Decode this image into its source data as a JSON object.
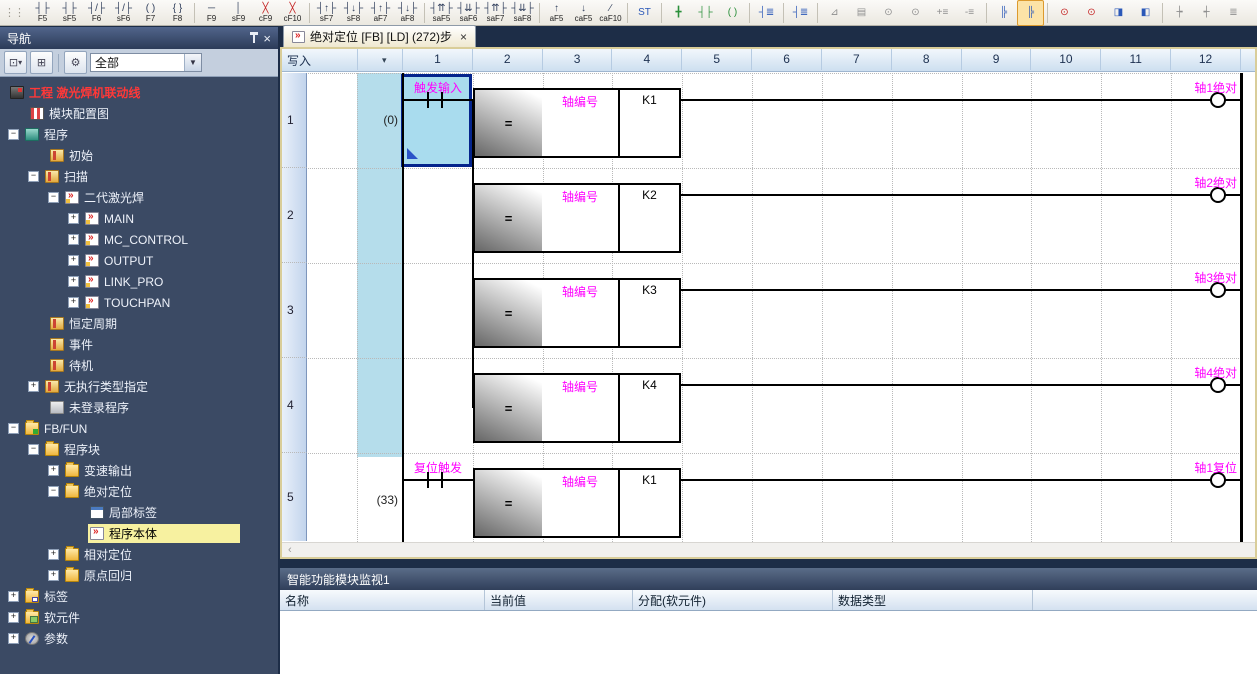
{
  "colors": {
    "accent_magenta": "#ff00ff",
    "selection_navy": "#04248c",
    "statement_cyan": "#b5ddeb",
    "nav_selected_yellow": "#f7f1a0",
    "active_window_border_tan": "#d9cd99",
    "project_red": "#ff3838"
  },
  "toolbar": {
    "grip": "⋮⋮",
    "overflow": "▾",
    "groups": [
      {
        "items": [
          {
            "n": "open-contact-icon",
            "g": "┤├",
            "l": "F5"
          },
          {
            "n": "parallel-open-contact-icon",
            "g": "┤├",
            "l": "sF5"
          },
          {
            "n": "closed-contact-icon",
            "g": "┤/├",
            "l": "F6"
          },
          {
            "n": "parallel-closed-contact-icon",
            "g": "┤/├",
            "l": "sF6"
          },
          {
            "n": "coil-icon",
            "g": "( )",
            "l": "F7"
          },
          {
            "n": "application-instruction-icon",
            "g": "{ }",
            "l": "F8"
          }
        ]
      },
      {
        "items": [
          {
            "n": "horizontal-line-icon",
            "g": "─",
            "l": "F9"
          },
          {
            "n": "vertical-line-icon",
            "g": "│",
            "l": "sF9"
          },
          {
            "n": "delete-horizontal-line-icon",
            "g": "╳",
            "c": "red",
            "l": "cF9"
          },
          {
            "n": "delete-vertical-line-icon",
            "g": "╳",
            "c": "red",
            "l": "cF10"
          }
        ]
      },
      {
        "items": [
          {
            "n": "rising-pulse-contact-icon",
            "g": "┤↑├",
            "l": "sF7"
          },
          {
            "n": "falling-pulse-contact-icon",
            "g": "┤↓├",
            "l": "sF8"
          },
          {
            "n": "parallel-rising-pulse-contact-icon",
            "g": "┤↑├",
            "l": "aF7"
          },
          {
            "n": "parallel-falling-pulse-contact-icon",
            "g": "┤↓├",
            "l": "aF8"
          }
        ]
      },
      {
        "items": [
          {
            "n": "rising-pulse-ne-contact-icon",
            "g": "┤⇈├",
            "l": "saF5"
          },
          {
            "n": "falling-pulse-ne-contact-icon",
            "g": "┤⇊├",
            "l": "saF6"
          },
          {
            "n": "parallel-rising-pulse-ne-icon",
            "g": "┤⇈├",
            "l": "saF7"
          },
          {
            "n": "parallel-falling-pulse-ne-icon",
            "g": "┤⇊├",
            "l": "saF8"
          }
        ]
      },
      {
        "items": [
          {
            "n": "rising-edge-operation-icon",
            "g": "↑",
            "l": "aF5"
          },
          {
            "n": "falling-edge-operation-icon",
            "g": "↓",
            "l": "caF5"
          },
          {
            "n": "invert-operation-icon",
            "g": "∕",
            "l": "caF10"
          }
        ]
      },
      {
        "items": [
          {
            "n": "inline-st-box-icon",
            "g": "ST",
            "c": "blue"
          }
        ]
      },
      {
        "items": [
          {
            "n": "edit-line-mode-icon",
            "g": "╋",
            "c": "green"
          },
          {
            "n": "edit-contact-mode-icon",
            "g": "┤├",
            "c": "green"
          },
          {
            "n": "edit-coil-mode-icon",
            "g": "( )",
            "c": "green"
          }
        ]
      },
      {
        "items": [
          {
            "n": "device-comment-edit-icon",
            "g": "┤≣",
            "c": "blue"
          }
        ]
      },
      {
        "items": [
          {
            "n": "device-comment-batch-icon",
            "g": "┤≣",
            "c": "blue"
          }
        ]
      },
      {
        "items": [
          {
            "n": "statement-edit-icon",
            "g": "⊿",
            "c": "gray"
          },
          {
            "n": "note-edit-icon",
            "g": "▤",
            "c": "gray"
          },
          {
            "n": "find-device-icon",
            "g": "⊙",
            "c": "gray"
          },
          {
            "n": "find-instruction-icon",
            "g": "⊙",
            "c": "gray"
          },
          {
            "n": "insert-statement-icon",
            "g": "+≡",
            "c": "gray"
          },
          {
            "n": "delete-statement-icon",
            "g": "-≡",
            "c": "gray"
          }
        ]
      },
      {
        "items": [
          {
            "n": "ladder-block-list-icon",
            "g": "╠",
            "c": "blue"
          },
          {
            "n": "ladder-edit-mode-icon",
            "g": "╠",
            "c": "blue",
            "hl": true
          }
        ]
      },
      {
        "items": [
          {
            "n": "monitor-find-icon",
            "g": "⊙",
            "c": "red"
          },
          {
            "n": "monitor-edit-icon",
            "g": "⊙",
            "c": "red"
          },
          {
            "n": "device-display-icon",
            "g": "◨",
            "c": "blue"
          },
          {
            "n": "device-batch-monitor-icon",
            "g": "◧",
            "c": "blue"
          }
        ]
      },
      {
        "items": [
          {
            "n": "device-skip-left-icon",
            "g": "┾",
            "c": "gray"
          },
          {
            "n": "device-skip-right-icon",
            "g": "┽",
            "c": "gray"
          },
          {
            "n": "align-list-icon",
            "g": "≣",
            "c": "gray"
          },
          {
            "n": "align-list-2-icon",
            "g": "≡",
            "c": "gray"
          },
          {
            "n": "watch-window-icon",
            "g": "⋜",
            "c": "gray"
          },
          {
            "n": "watch-register-icon",
            "g": "⊴",
            "c": "gray"
          }
        ]
      },
      {
        "items": [
          {
            "n": "write-to-plc-icon",
            "g": "▦",
            "c": "dark"
          },
          {
            "n": "read-from-plc-icon",
            "g": "▦",
            "c": "darkred"
          }
        ]
      }
    ]
  },
  "nav": {
    "title": "导航",
    "filter": "全部",
    "tree": [
      {
        "t": "工程 激光焊机联动线",
        "ind": 0,
        "icon": "project",
        "red": true
      },
      {
        "t": "模块配置图",
        "ind": 1,
        "icon": "module"
      },
      {
        "t": "程序",
        "ind": 0,
        "exp": "-",
        "icon": "prog"
      },
      {
        "t": "初始",
        "ind": 2,
        "icon": "file"
      },
      {
        "t": "扫描",
        "ind": 1,
        "exp": "-",
        "icon": "file"
      },
      {
        "t": "二代激光焊",
        "ind": 2,
        "exp": "-",
        "icon": "pou"
      },
      {
        "t": "MAIN",
        "ind": 3,
        "exp": "+",
        "icon": "pou"
      },
      {
        "t": "MC_CONTROL",
        "ind": 3,
        "exp": "+",
        "icon": "pou"
      },
      {
        "t": "OUTPUT",
        "ind": 3,
        "exp": "+",
        "icon": "pou"
      },
      {
        "t": "LINK_PRO",
        "ind": 3,
        "exp": "+",
        "icon": "pou"
      },
      {
        "t": "TOUCHPAN",
        "ind": 3,
        "exp": "+",
        "icon": "pou"
      },
      {
        "t": "恒定周期",
        "ind": 2,
        "icon": "file"
      },
      {
        "t": "事件",
        "ind": 2,
        "icon": "file"
      },
      {
        "t": "待机",
        "ind": 2,
        "icon": "file"
      },
      {
        "t": "无执行类型指定",
        "ind": 1,
        "exp": "+",
        "icon": "file"
      },
      {
        "t": "未登录程序",
        "ind": 2,
        "icon": "grayfile"
      },
      {
        "t": "FB/FUN",
        "ind": 0,
        "exp": "-",
        "icon": "fbfun"
      },
      {
        "t": "程序块",
        "ind": 1,
        "exp": "-",
        "icon": "folder"
      },
      {
        "t": "变速输出",
        "ind": 2,
        "exp": "+",
        "icon": "folder"
      },
      {
        "t": "绝对定位",
        "ind": 2,
        "exp": "-",
        "icon": "folder"
      },
      {
        "t": "局部标签",
        "ind": 4,
        "icon": "labeltable"
      },
      {
        "t": "程序本体",
        "ind": 4,
        "icon": "body",
        "sel": true
      },
      {
        "t": "相对定位",
        "ind": 2,
        "exp": "+",
        "icon": "folder"
      },
      {
        "t": "原点回归",
        "ind": 2,
        "exp": "+",
        "icon": "folder"
      },
      {
        "t": "标签",
        "ind": 0,
        "exp": "+",
        "icon": "labelfolder"
      },
      {
        "t": "软元件",
        "ind": 0,
        "exp": "+",
        "icon": "device"
      },
      {
        "t": "参数",
        "ind": 0,
        "exp": "+",
        "icon": "param"
      }
    ]
  },
  "editor": {
    "tab": {
      "title": "绝对定位 [FB] [LD] (272)步",
      "close": "×"
    },
    "mode": "写入",
    "dropdown": "▾",
    "scroll_left": "‹",
    "columns": [
      "1",
      "2",
      "3",
      "4",
      "5",
      "6",
      "7",
      "8",
      "9",
      "10",
      "11",
      "12"
    ],
    "rungs": [
      {
        "row": "1",
        "step": "(0)",
        "contact": {
          "label": "触发输入",
          "selected": true
        },
        "block": {
          "op": "=",
          "param": "轴编号",
          "value": "K1"
        },
        "coil": "轴1绝对",
        "branch": false
      },
      {
        "row": "2",
        "block": {
          "op": "=",
          "param": "轴编号",
          "value": "K2"
        },
        "coil": "轴2绝对",
        "branch": true
      },
      {
        "row": "3",
        "block": {
          "op": "=",
          "param": "轴编号",
          "value": "K3"
        },
        "coil": "轴3绝对",
        "branch": true
      },
      {
        "row": "4",
        "block": {
          "op": "=",
          "param": "轴编号",
          "value": "K4"
        },
        "coil": "轴4绝对",
        "branch": true
      },
      {
        "row": "5",
        "step": "(33)",
        "contact": {
          "label": "复位触发"
        },
        "block": {
          "op": "=",
          "param": "轴编号",
          "value": "K1"
        },
        "coil": "轴1复位",
        "branch": false
      }
    ]
  },
  "monitor": {
    "title": "智能功能模块监视1",
    "columns": [
      "名称",
      "当前值",
      "分配(软元件)",
      "数据类型"
    ]
  }
}
